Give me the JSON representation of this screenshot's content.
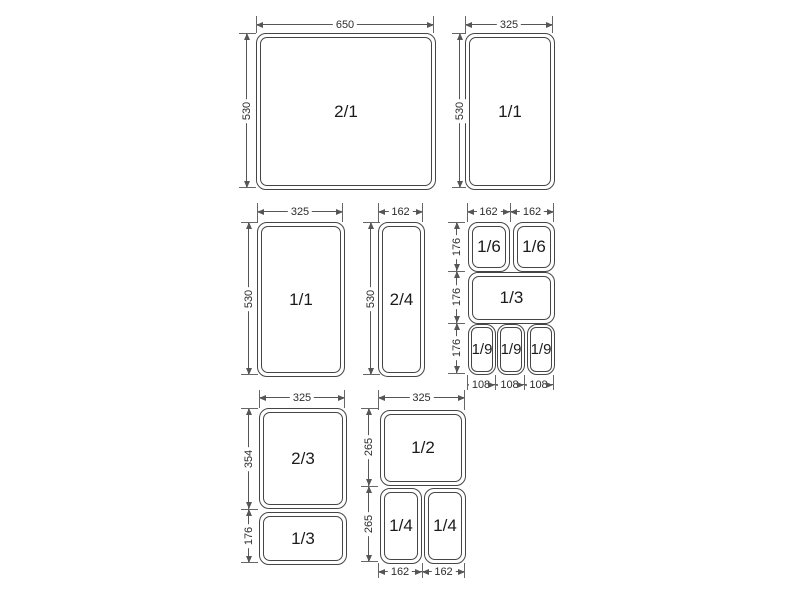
{
  "colors": {
    "line": "#555555",
    "text": "#1b1b1b",
    "background": "#ffffff"
  },
  "groups": [
    {
      "id": "pan-2-1",
      "pans": [
        {
          "label": "2/1"
        }
      ],
      "dims": {
        "top": [
          {
            "value": "650"
          }
        ],
        "left": [
          {
            "value": "530"
          }
        ]
      }
    },
    {
      "id": "pan-1-1-upper",
      "pans": [
        {
          "label": "1/1"
        }
      ],
      "dims": {
        "top": [
          {
            "value": "325"
          }
        ],
        "left": [
          {
            "value": "530"
          }
        ]
      }
    },
    {
      "id": "pan-1-1-middle",
      "pans": [
        {
          "label": "1/1"
        }
      ],
      "dims": {
        "top": [
          {
            "value": "325"
          }
        ],
        "left": [
          {
            "value": "530"
          }
        ]
      }
    },
    {
      "id": "pan-2-4",
      "pans": [
        {
          "label": "2/4"
        }
      ],
      "dims": {
        "top": [
          {
            "value": "162"
          }
        ],
        "left": [
          {
            "value": "530"
          }
        ]
      }
    },
    {
      "id": "pans-sixths-third-ninths",
      "pans": [
        {
          "label": "1/6"
        },
        {
          "label": "1/6"
        },
        {
          "label": "1/3"
        },
        {
          "label": "1/9"
        },
        {
          "label": "1/9"
        },
        {
          "label": "1/9"
        }
      ],
      "dims": {
        "top": [
          {
            "value": "162"
          },
          {
            "value": "162"
          }
        ],
        "left": [
          {
            "value": "176"
          },
          {
            "value": "176"
          },
          {
            "value": "176"
          }
        ],
        "bottom": [
          {
            "value": "108"
          },
          {
            "value": "108"
          },
          {
            "value": "108"
          }
        ]
      }
    },
    {
      "id": "pans-two-thirds-and-third",
      "pans": [
        {
          "label": "2/3"
        },
        {
          "label": "1/3"
        }
      ],
      "dims": {
        "top": [
          {
            "value": "325"
          }
        ],
        "left": [
          {
            "value": "354"
          },
          {
            "value": "176"
          }
        ]
      }
    },
    {
      "id": "pans-half-and-quarters",
      "pans": [
        {
          "label": "1/2"
        },
        {
          "label": "1/4"
        },
        {
          "label": "1/4"
        }
      ],
      "dims": {
        "top": [
          {
            "value": "325"
          }
        ],
        "left": [
          {
            "value": "265"
          },
          {
            "value": "265"
          }
        ],
        "bottom": [
          {
            "value": "162"
          },
          {
            "value": "162"
          }
        ]
      }
    }
  ]
}
